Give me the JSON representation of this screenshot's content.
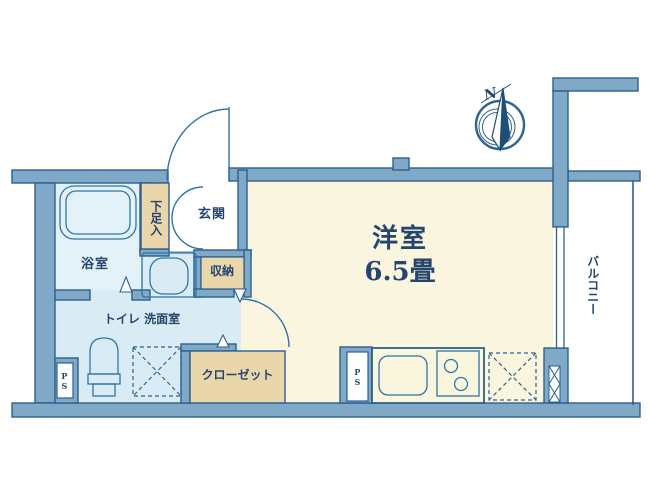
{
  "plan": {
    "rooms": {
      "bathroom": {
        "label": "浴室"
      },
      "shoe_cabinet": {
        "label": "下足入"
      },
      "entrance": {
        "label": "玄関"
      },
      "storage": {
        "label": "収納"
      },
      "toilet_washroom": {
        "label": "トイレ 洗面室"
      },
      "closet": {
        "label": "クローゼット"
      },
      "western_room": {
        "label": "洋室",
        "size": "6.5畳"
      },
      "balcony": {
        "label": "バルコニー"
      },
      "pipe_space_left": {
        "label": "PS"
      },
      "pipe_space_kitchen": {
        "label": "PS"
      }
    },
    "compass": {
      "north_label": "N"
    },
    "colors": {
      "wall_fill": "#7fa9c6",
      "wall_outline": "#2d5f8d",
      "wet_room_blue": "#d9ecf5",
      "main_room_cream": "#faf5df",
      "cabinet_tan": "#e9d7ab",
      "text_navy": "#26456e",
      "fixture_blue": "#2f74a8"
    }
  }
}
